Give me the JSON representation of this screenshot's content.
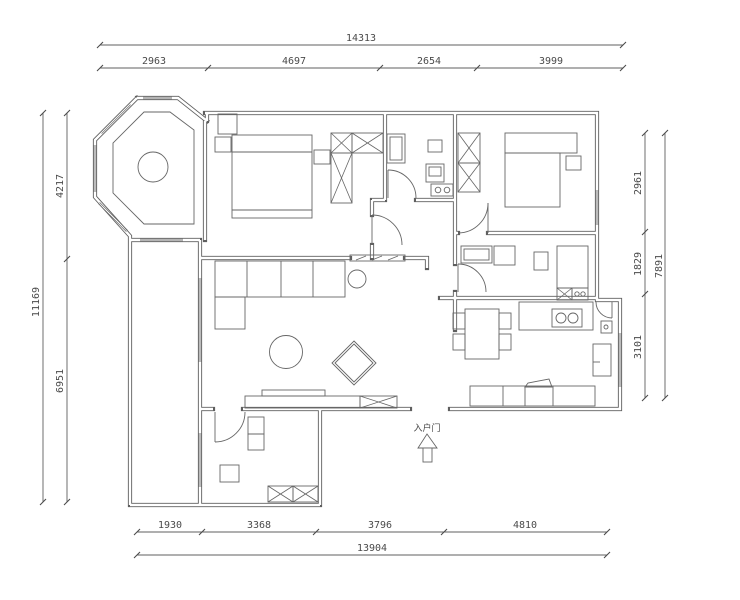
{
  "drawing": {
    "type": "apartment-floor-plan",
    "units": "mm"
  },
  "dims": {
    "top": {
      "total": "14313",
      "segments": [
        "2963",
        "4697",
        "2654",
        "3999"
      ]
    },
    "left": {
      "total": "11169",
      "segments": [
        "4217",
        "6951"
      ]
    },
    "right": {
      "total": "7891",
      "segments": [
        "2961",
        "1829",
        "3101"
      ]
    },
    "bottom": {
      "total": "13904",
      "segments": [
        "1930",
        "3368",
        "3796",
        "4810"
      ]
    }
  },
  "labels": {
    "entrance": "入户门"
  },
  "colors": {
    "background": "#ffffff",
    "line": "#5f5f5f",
    "text": "#4a4a4a"
  }
}
